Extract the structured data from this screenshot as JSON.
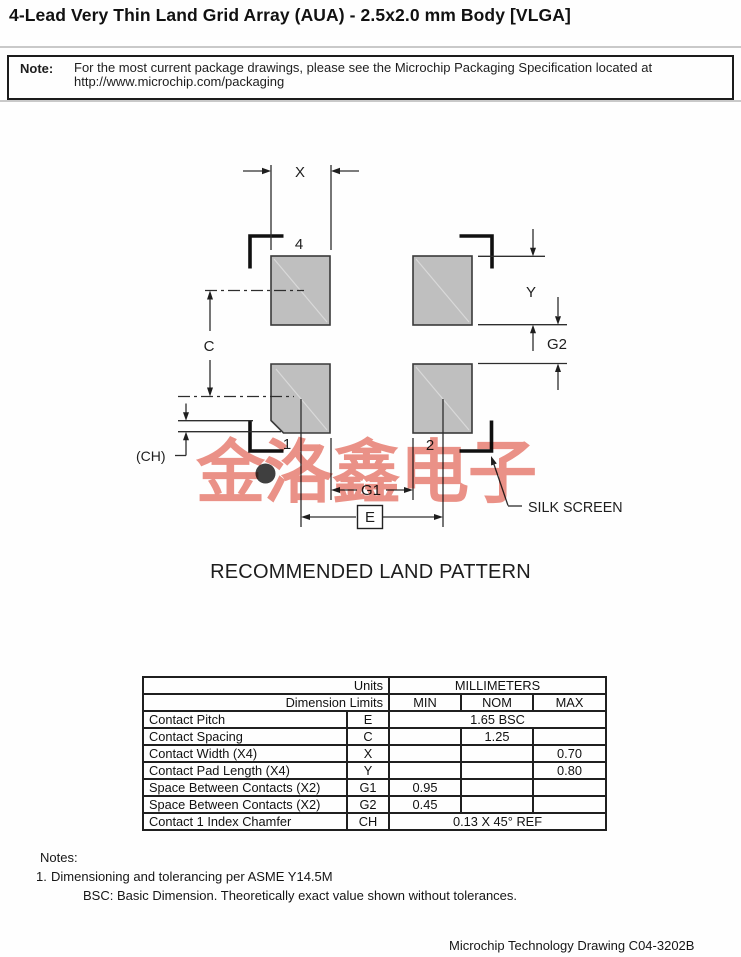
{
  "page": {
    "title": "4-Lead Very Thin Land Grid Array (AUA) - 2.5x2.0 mm Body [VLGA]"
  },
  "note": {
    "label": "Note:",
    "line1": "For the most current package drawings, please see the Microchip Packaging Specification located at",
    "line2": "http://www.microchip.com/packaging"
  },
  "drawing": {
    "caption": "RECOMMENDED LAND PATTERN",
    "watermark": "金洛鑫电子",
    "labels": {
      "x": "X",
      "y": "Y",
      "c": "C",
      "g1": "G1",
      "g2": "G2",
      "e": "E",
      "ch": "(CH)",
      "silk_screen": "SILK SCREEN",
      "pad1": "1",
      "pad2": "2",
      "pad4": "4"
    },
    "colors": {
      "pad_fill": "#bfbfbf",
      "pad_stroke": "#3a3a3a",
      "line": "#2e2e2e",
      "silk_bracket": "#101010",
      "watermark": "#e87f73"
    }
  },
  "table": {
    "header": {
      "units_label": "Units",
      "millimeters_label": "MILLIMETERS",
      "dimension_limits_label": "Dimension Limits",
      "min": "MIN",
      "nom": "NOM",
      "max": "MAX"
    },
    "rows": [
      {
        "name": "Contact Pitch",
        "symbol": "E",
        "value": "1.65 BSC"
      },
      {
        "name": "Contact Spacing",
        "symbol": "C",
        "min": "",
        "nom": "1.25",
        "max": ""
      },
      {
        "name": "Contact Width (X4)",
        "symbol": "X",
        "min": "",
        "nom": "",
        "max": "0.70"
      },
      {
        "name": "Contact Pad Length (X4)",
        "symbol": "Y",
        "min": "",
        "nom": "",
        "max": "0.80"
      },
      {
        "name": "Space Between Contacts (X2)",
        "symbol": "G1",
        "min": "0.95",
        "nom": "",
        "max": ""
      },
      {
        "name": "Space Between Contacts (X2)",
        "symbol": "G2",
        "min": "0.45",
        "nom": "",
        "max": ""
      },
      {
        "name": "Contact 1 Index Chamfer",
        "symbol": "CH",
        "value": "0.13 X 45° REF"
      }
    ]
  },
  "notes": {
    "heading": "Notes:",
    "item1_num": "1.",
    "item1": "Dimensioning and tolerancing per ASME Y14.5M",
    "item2": "BSC: Basic Dimension. Theoretically exact value shown without tolerances."
  },
  "footer": {
    "text": "Microchip Technology Drawing C04-3202B"
  }
}
